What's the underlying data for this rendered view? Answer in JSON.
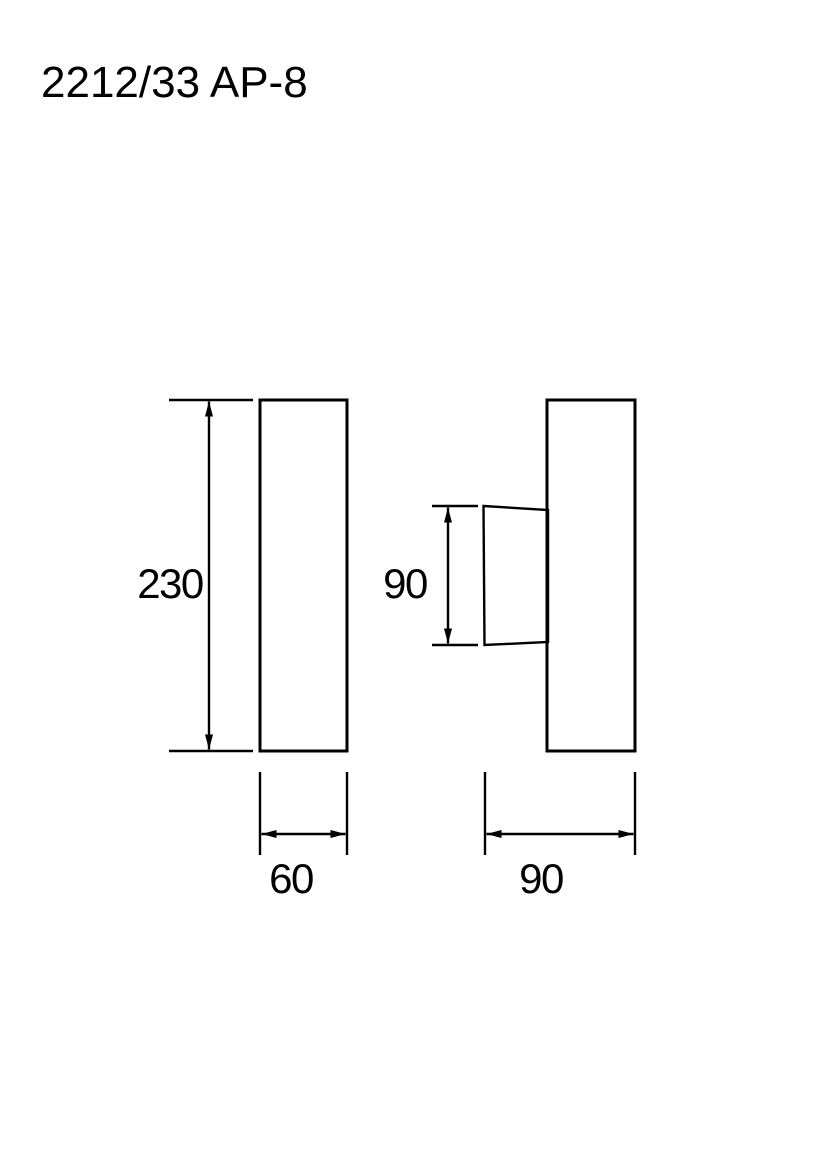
{
  "title": "2212/33 AP-8",
  "colors": {
    "background": "#ffffff",
    "ink": "#000000"
  },
  "drawing": {
    "type": "technical-dimension-drawing",
    "front_view": {
      "height": "230",
      "width": "60"
    },
    "side_view": {
      "shade_height": "90",
      "depth": "90"
    }
  }
}
